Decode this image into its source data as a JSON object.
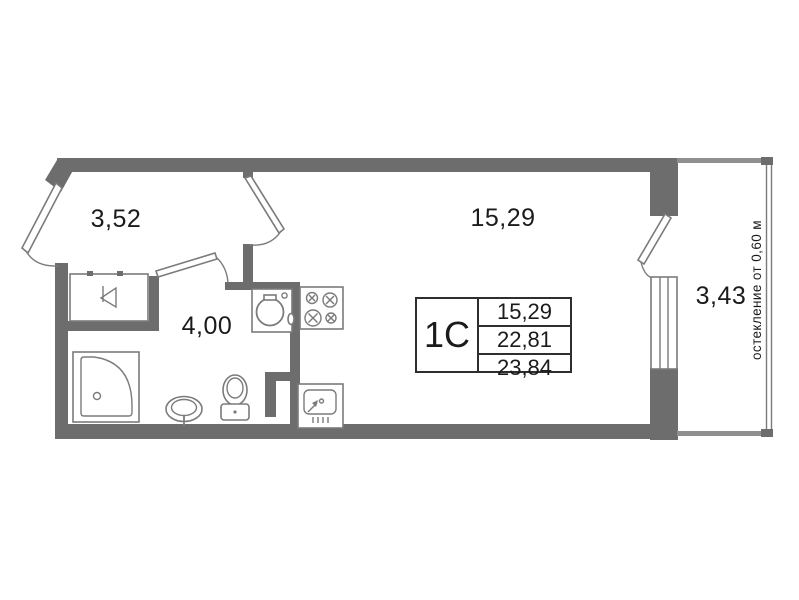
{
  "plan_labels": {
    "hall_area": "3,52",
    "room_area": "15,29",
    "corridor_area": "4,00",
    "balcony_area": "3,43",
    "glazing_note": "остекление от 0,60 м"
  },
  "info_table": {
    "unit_type": "1С",
    "values": [
      "15,29",
      "22,81",
      "23,84"
    ]
  },
  "colors": {
    "bg": "#ffffff",
    "wall": "#6d6d6d",
    "fixture": "#7b7b7b",
    "thin": "#8f8f8f",
    "text": "#1b1b1b",
    "table_border": "#2e2e2e"
  }
}
